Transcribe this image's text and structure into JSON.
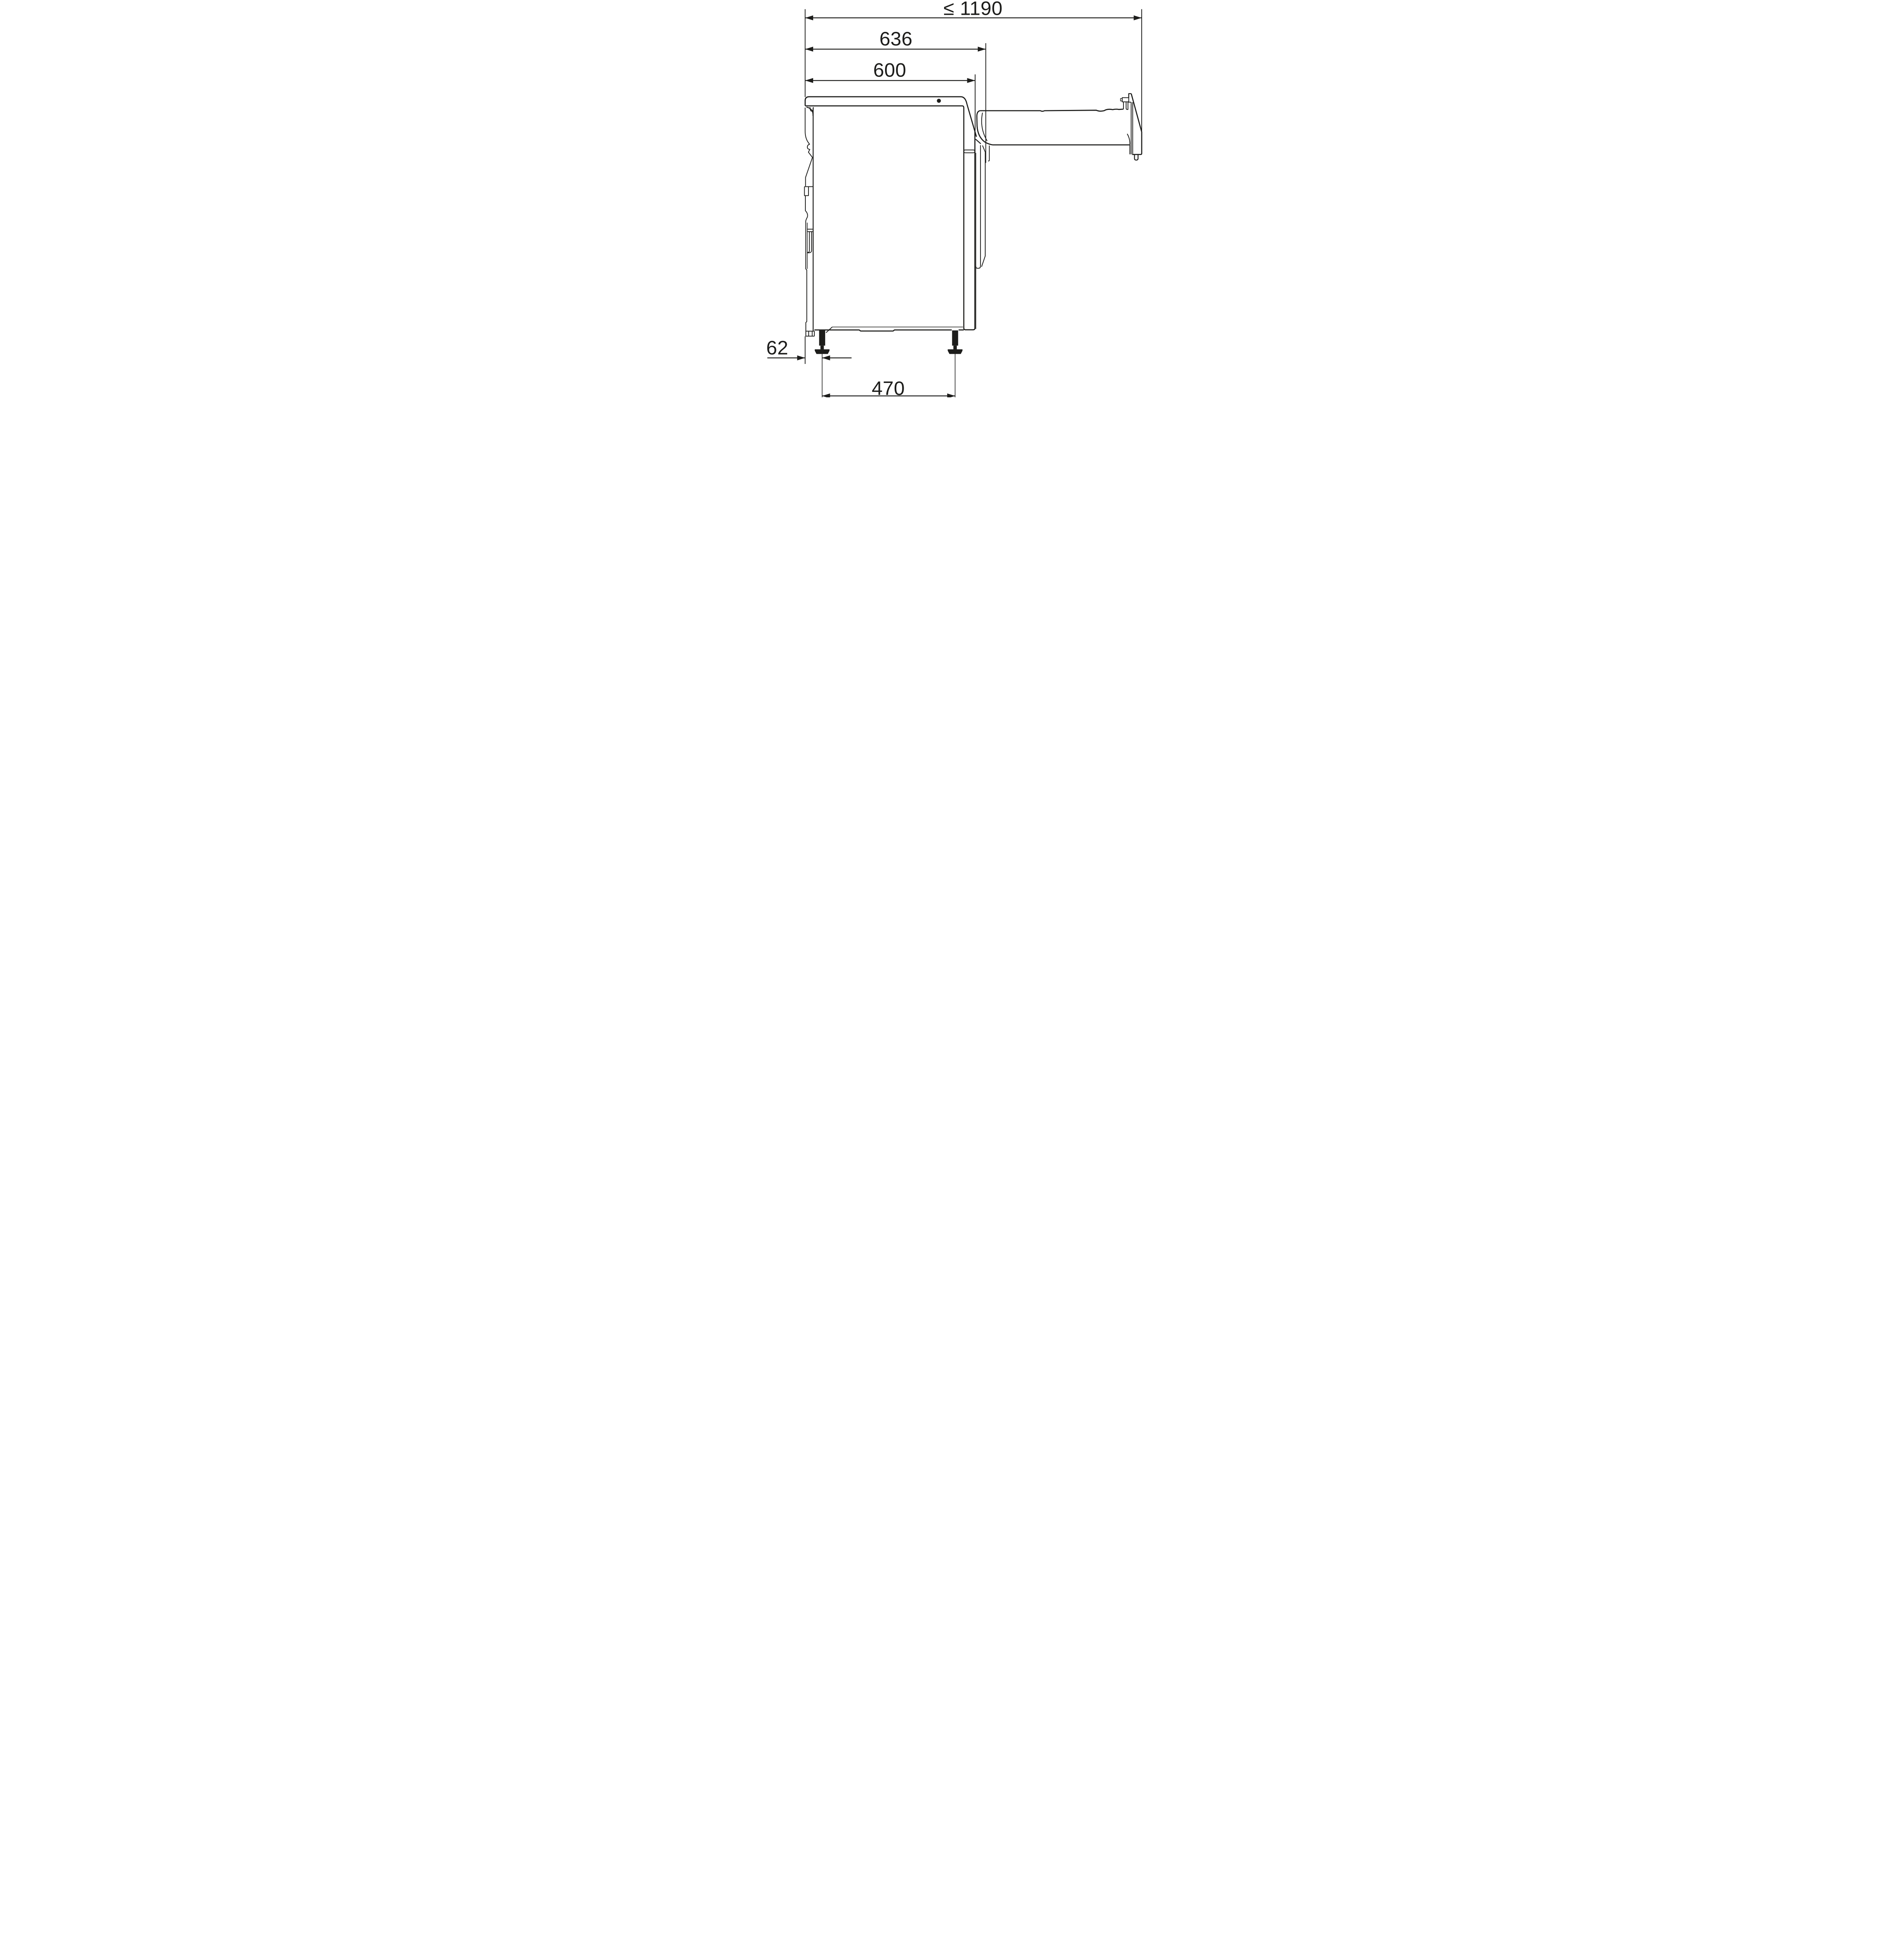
{
  "diagram": {
    "type": "technical-dimension-drawing",
    "labels": {
      "total_depth_door_open": "≤ 1190",
      "depth_with_door": "636",
      "body_depth": "600",
      "rear_foot_inset": "62",
      "foot_spacing": "470"
    },
    "colors": {
      "line": "#1d1d1b",
      "background": "#ffffff"
    }
  }
}
